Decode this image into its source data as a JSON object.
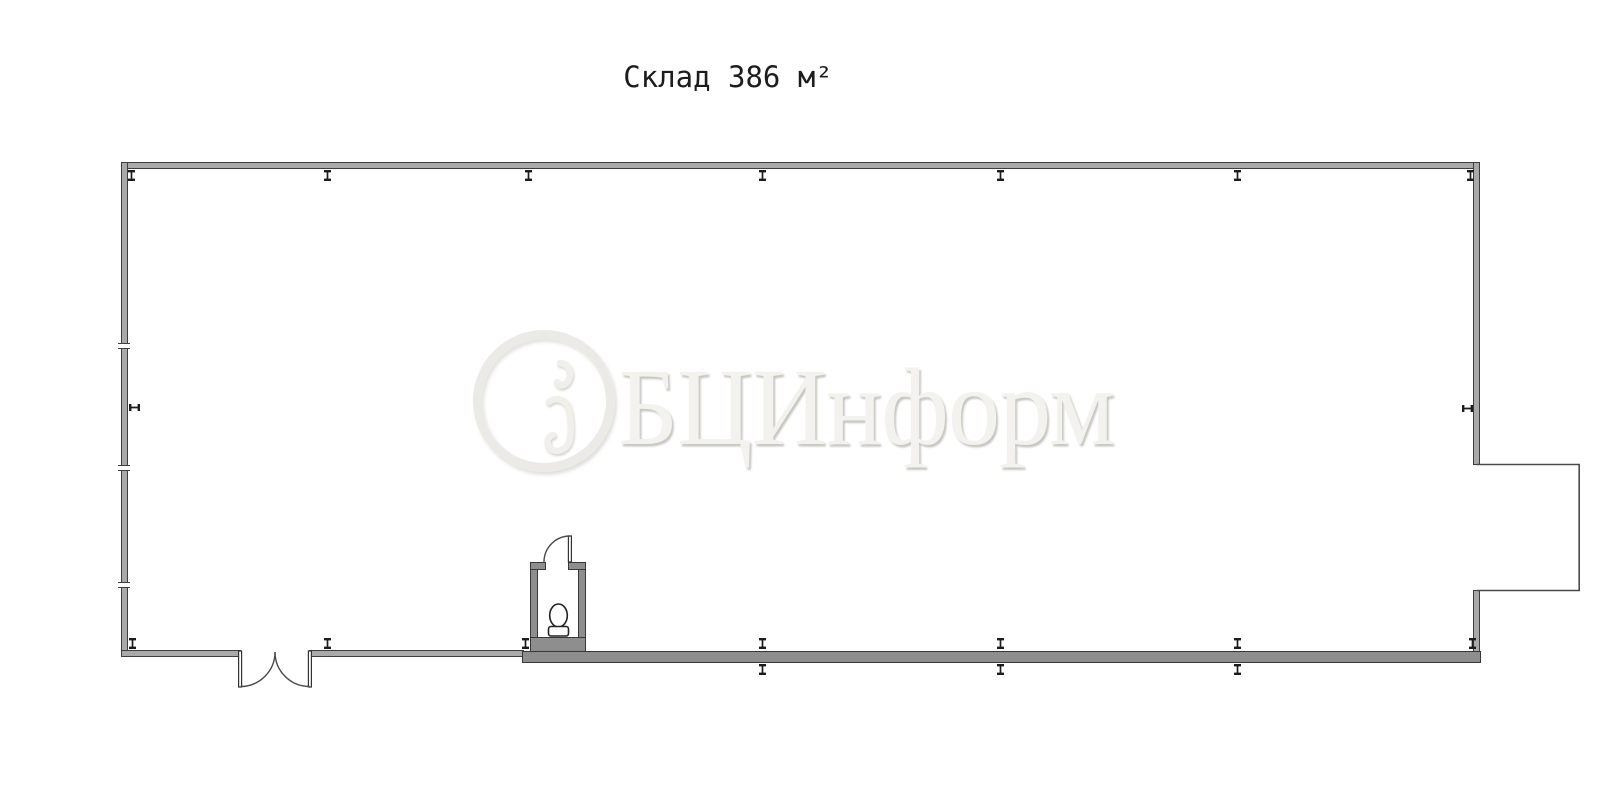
{
  "title": {
    "text": "Склад 386 м²"
  },
  "watermark": {
    "text": "БЦИнформ",
    "logo": "bc-inform-circle-logo"
  },
  "plan": {
    "area_label": "Склад 386 м²",
    "room": "Склад",
    "area_m2": "386",
    "colors": {
      "wall_outline": "#3e3e3e",
      "wall_fill": "#a9a9a9",
      "wall_fill_dark": "#8e8e8e",
      "line": "#4a4a4a"
    },
    "columns": {
      "top": [
        131,
        327,
        528,
        762,
        1000,
        1237,
        1470
      ],
      "bottom_above": [
        132,
        327,
        525,
        762,
        1000,
        1237,
        1472
      ],
      "bottom_below": [
        762,
        1000,
        1237
      ],
      "left": [
        407
      ],
      "right": [
        408
      ]
    },
    "left_wall_joints": [
      346,
      468,
      585
    ]
  }
}
